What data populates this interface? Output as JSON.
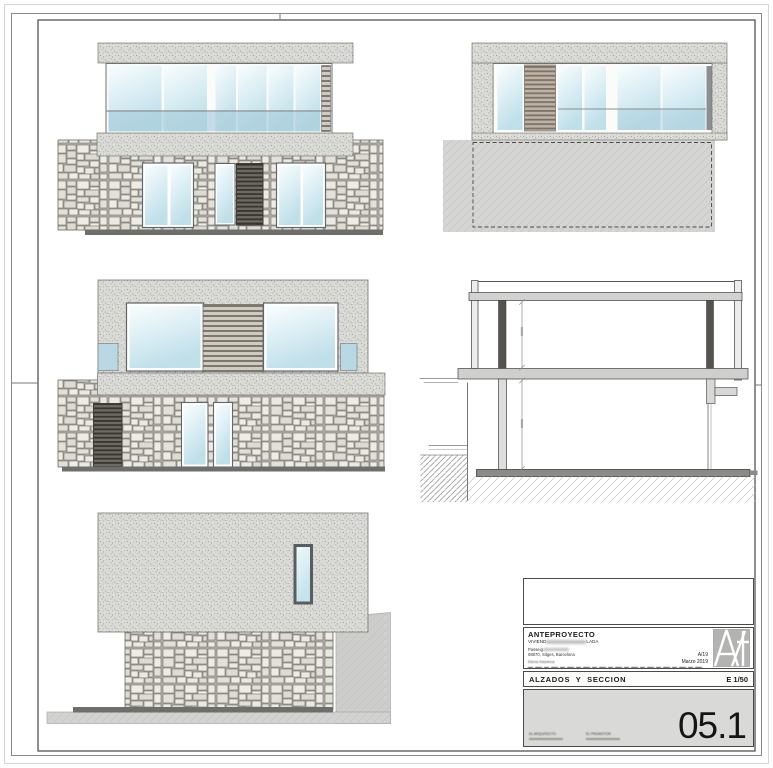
{
  "sheet": {
    "views": [
      "front-elevation",
      "rear-elevation",
      "side-elevation-left",
      "cross-section",
      "side-elevation-right"
    ]
  },
  "title_block": {
    "doc_type": "ANTEPROYECTO",
    "project_prefix": "VIVIEND",
    "project_suffix": "LADA",
    "address_prefix": "Passeig",
    "city_line": "08870, Sitges, Barcelona",
    "ref": "A/19",
    "author": "Elena Kiseleva",
    "date": "Marzo 2019",
    "sheet_title": "ALZADOS Y SECCION",
    "scale": "E 1/50",
    "sheet_number": "05.1",
    "sig_left": "EL ARQUITECTO",
    "sig_right": "EL PROMOTOR"
  },
  "palette": {
    "stone_fill": "#e9e6df",
    "mortar": "#b5b2aa",
    "stucco": "#d9d9d6",
    "glass_light": "#f8fdfe",
    "glass_dark": "#bfdfe9",
    "balcony_glass": "#a9cddb",
    "terrain": "#d2d2d0",
    "ground_bar": "#6e6e6c",
    "frame_line": "#555555",
    "number_box_bg": "#d9d9d7"
  }
}
